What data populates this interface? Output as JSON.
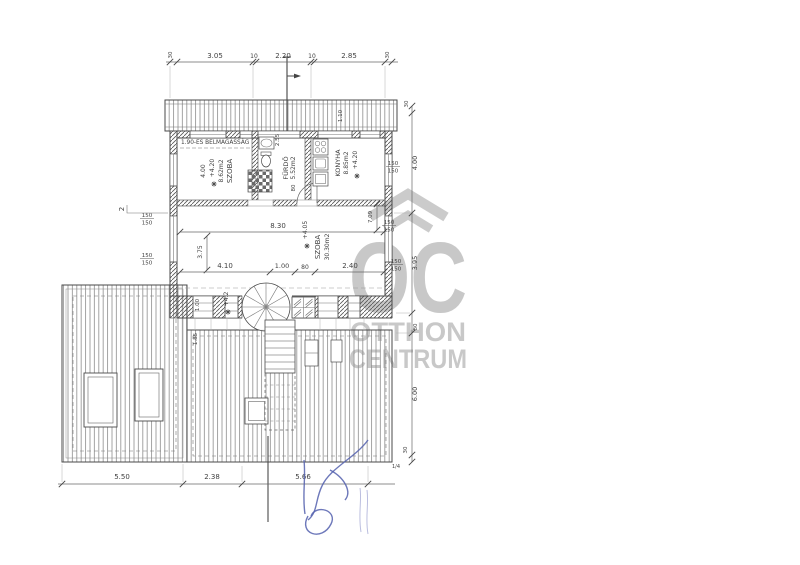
{
  "watermark": {
    "monogram": "OC",
    "line1": "OTTHON",
    "line2": "CENTRUM"
  },
  "colors": {
    "ink": "#3f3f3f",
    "watermark_gray": "#c6c6c6",
    "signature_blue": "#5460ae"
  },
  "plan": {
    "rooms": {
      "szoba1": {
        "name": "SZOBA",
        "area": "8.62m2",
        "level": "+4.20",
        "clear_height": "4.00"
      },
      "furdo": {
        "name": "FÜRDŐ",
        "area": "5.52m2"
      },
      "konyha": {
        "name": "KONYHA",
        "area": "8.85m2",
        "level": "+4.20"
      },
      "nagyszoba": {
        "name": "SZOBA",
        "area": "30.30m2",
        "level": "+4.05"
      },
      "stair_area": {
        "level": "+4.2"
      }
    },
    "notes": {
      "headroom": "1.90-ES BELMAGASSÁG"
    },
    "dims": {
      "top": [
        "30",
        "3.05",
        "10",
        "2.20",
        "10",
        "2.85",
        "30"
      ],
      "right": [
        "30",
        "4.00",
        "3.95",
        "80",
        "6.00",
        "30"
      ],
      "interior": {
        "w": "8.30",
        "h1": "3.75",
        "h2": "7.09",
        "b": [
          "4.10",
          "1.00",
          "80",
          "2.40"
        ]
      },
      "upper": {
        "bath_w": "2.55",
        "bath_door": "80",
        "edge": "1.10"
      },
      "stair": {
        "w": "1.00",
        "h": "1.85"
      },
      "bottom": [
        "5.50",
        "2.38",
        "5.66"
      ],
      "window_size": "150",
      "section_no": "2",
      "quarter": "1/4"
    }
  }
}
